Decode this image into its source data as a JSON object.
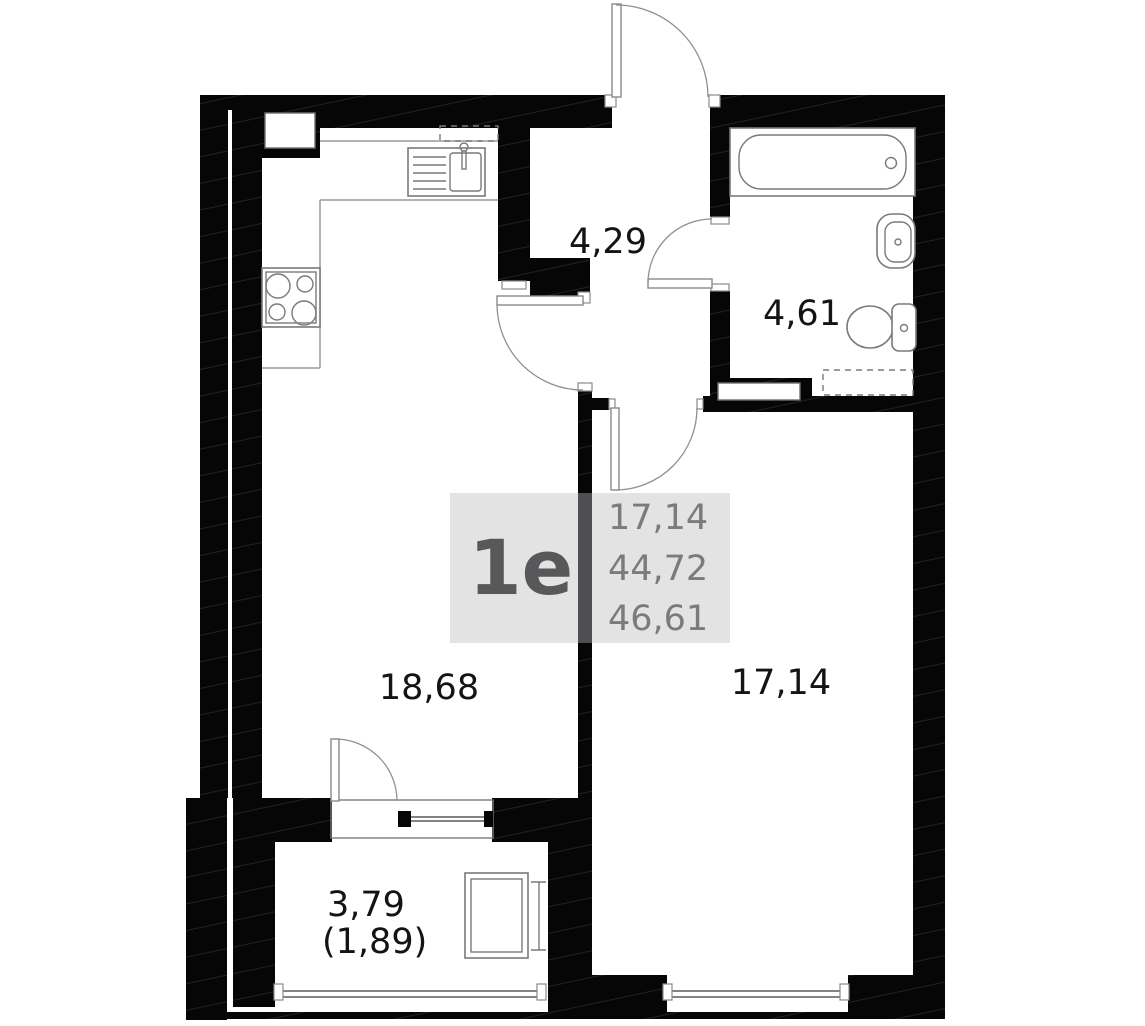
{
  "legend": {
    "unit_type": "1e",
    "room_area": "17,14",
    "living_area": "44,72",
    "total_area": "46,61"
  },
  "room_labels": {
    "hallway": "4,29",
    "bathroom": "4,61",
    "kitchen_living": "18,68",
    "bedroom": "17,14",
    "balcony": "3,79",
    "balcony_coefficient": "(1,89)"
  },
  "colors": {
    "wall": "#060606",
    "legend_bg": "#e3e3e3",
    "legend_divider": "#4f4f51",
    "legend_unit_text": "#58585a",
    "legend_area_text": "#7b7b7d",
    "room_label_text": "#141414",
    "fixture_outline": "#7a7a7a"
  }
}
